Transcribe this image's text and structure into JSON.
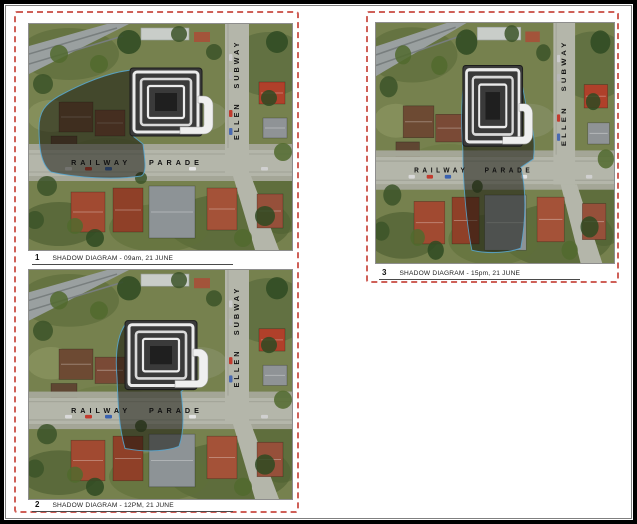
{
  "page": {
    "background": "#ffffff",
    "border_color": "#000000"
  },
  "colors": {
    "dashed_border": "#cf6058",
    "grass": "#76814e",
    "road": "#b4b6aa",
    "sidewalk": "#a4a697",
    "railway": "#9aa0a0",
    "building_base": "#3a3a3a",
    "building_bands": "#ebebeb",
    "shadow_fill": "rgba(22,22,14,0.52)",
    "shadow_outline": "#57a8d2",
    "street_text": "#111111"
  },
  "map_labels": {
    "horizontal_street": "RAILWAY PARADE",
    "vertical_street": "ELLEN SUBWAY"
  },
  "panels": [
    {
      "number": "1",
      "caption": "SHADOW DIAGRAM - 09am, 21 JUNE",
      "time": "09am, 21 JUNE",
      "shadow_direction": "west",
      "building": {
        "x": 101,
        "y": 44,
        "w": 72,
        "h": 68
      },
      "shadow_path": "M 103 46 C 80 48 52 60 30 72 C 16 80 10 88 10 104 C 10 124 12 140 22 148 C 48 154 86 156 112 152 C 118 150 116 136 114 120 L 104 112 Z"
    },
    {
      "number": "2",
      "caption": "SHADOW DIAGRAM - 12PM, 21 JUNE",
      "time": "12PM, 21 JUNE",
      "shadow_direction": "south",
      "building": {
        "x": 96,
        "y": 50,
        "w": 72,
        "h": 68
      },
      "shadow_path": "M 96 54 C 88 66 86 84 88 106 C 89 132 90 156 96 176 C 114 180 138 179 150 174 C 156 158 154 136 152 120 L 162 112 C 166 96 168 74 166 60 C 146 52 116 50 96 54 Z"
    },
    {
      "number": "3",
      "caption": "SHADOW DIAGRAM - 15pm, 21 JUNE",
      "time": "15pm, 21 JUNE",
      "shadow_direction": "south-east",
      "building": {
        "x": 96,
        "y": 40,
        "w": 66,
        "h": 76
      },
      "shadow_path": "M 98 50 C 94 70 94 96 96 120 C 96 150 100 190 106 214 C 126 218 148 216 160 212 C 166 184 166 156 160 136 L 174 128 C 176 112 174 98 168 88 L 162 60 C 142 50 116 46 98 50 Z"
    }
  ]
}
